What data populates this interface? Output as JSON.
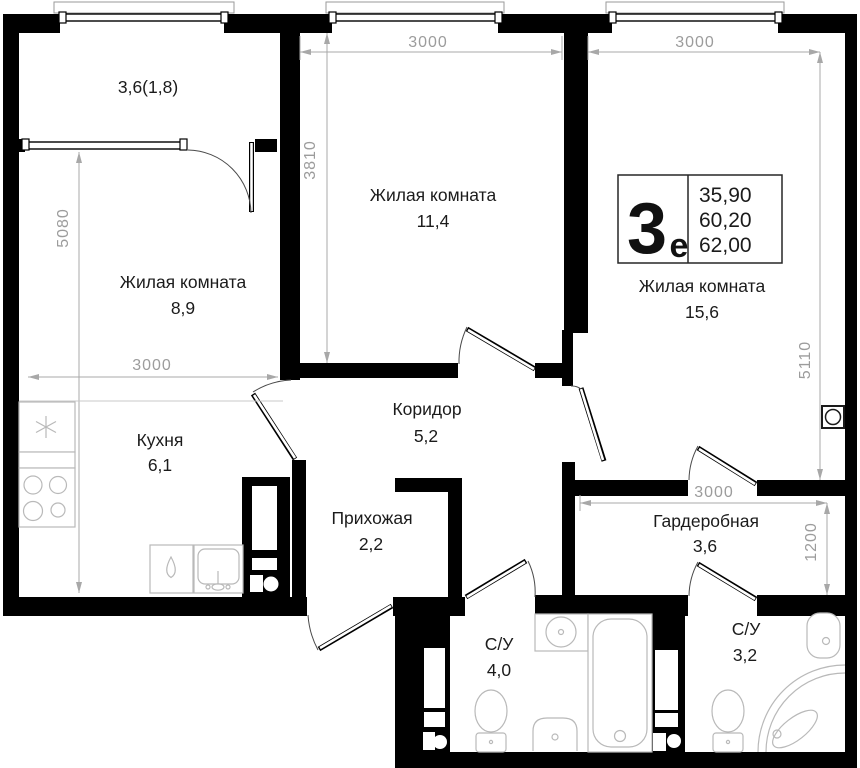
{
  "plan_title": "3-room euro apartment floor plan",
  "info_box": {
    "type_big": "3",
    "type_small": "е",
    "area_living": "35,90",
    "area_apartment": "60,20",
    "area_total": "62,00"
  },
  "rooms": {
    "balcony": {
      "area": "3,6(1,8)"
    },
    "room_top": {
      "name": "Жилая комната",
      "area": "11,4"
    },
    "room_left": {
      "name": "Жилая комната",
      "area": "8,9"
    },
    "room_right": {
      "name": "Жилая комната",
      "area": "15,6"
    },
    "kitchen": {
      "name": "Кухня",
      "area": "6,1"
    },
    "corridor": {
      "name": "Коридор",
      "area": "5,2"
    },
    "hallway": {
      "name": "Прихожая",
      "area": "2,2"
    },
    "wardrobe": {
      "name": "Гардеробная",
      "area": "3,6"
    },
    "bath_main": {
      "name": "С/У",
      "area": "4,0"
    },
    "bath_second": {
      "name": "С/У",
      "area": "3,2"
    }
  },
  "dimensions": {
    "room_top_w": "3000",
    "room_top_h": "3810",
    "left_zone_h": "5080",
    "left_zone_w": "3000",
    "room_right_w": "3000",
    "room_right_h": "5110",
    "wardrobe_w": "3000",
    "wardrobe_h": "1200"
  },
  "colors": {
    "wall": "#000000",
    "dimension": "#a8a8a8",
    "fixture": "#b9b9b9",
    "label": "#1b1b1b"
  }
}
